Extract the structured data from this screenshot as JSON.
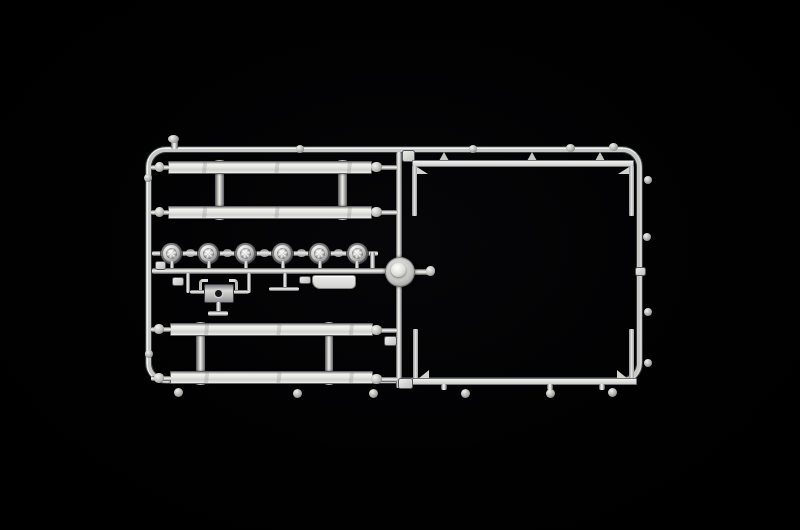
{
  "scene": {
    "description": "Photograph of a silver-grey injection-molded plastic model kit sprue (parts tree) lying on a black background",
    "background": "#000000",
    "colors": {
      "bg": "#000000",
      "hi": "#f6f6f2",
      "base": "#dcdcd8",
      "mid": "#b9b9b5",
      "dark": "#5a5a60",
      "ink": "#343a42"
    },
    "sprue": {
      "frame": "rounded rectangular outer runner frame with a central vertical runner divider",
      "sections": {
        "upper_left": "two long flat bars joined by two vertical posts",
        "middle_left": "row of six round faceted lamp lenses on a runner, above a mounting bracket, an axle pin and a flat plate",
        "center": "domed circular hub at the junction of the central vertical runner",
        "lower_left": "second pair of long flat bars joined by two vertical posts",
        "right": "large open bay with two thin guard rails moulded along the top and bottom runners"
      },
      "parts_detail": {
        "headlamps": {
          "count": 6,
          "start_x": 171.5,
          "spacing": 37.1,
          "center_y": 253,
          "diameter": 21,
          "core": 11
        },
        "long_bars": {
          "count": 4
        },
        "guard_rails": {
          "count": 2
        },
        "round_hub": {
          "count": 1
        },
        "mount_bracket": {
          "count": 1
        },
        "axle_pin": {
          "count": 1
        },
        "flat_plate": {
          "count": 1
        },
        "small_tabs": {
          "count": 6
        }
      }
    }
  }
}
